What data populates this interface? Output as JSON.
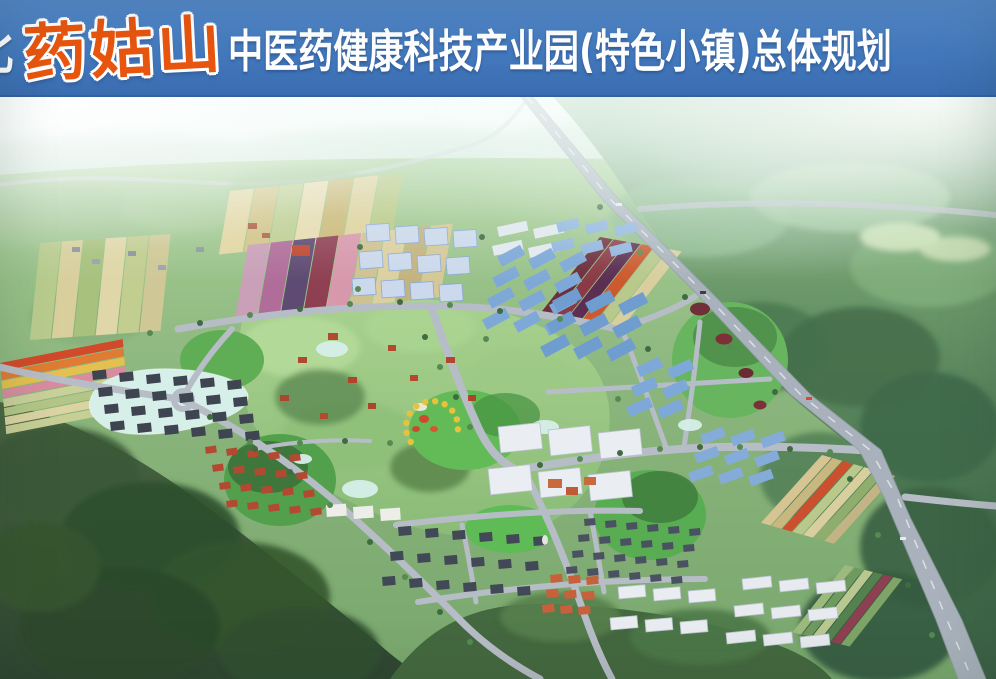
{
  "banner": {
    "region": "湖北",
    "brand": "药姑山",
    "suffix": "中医药健康科技产业园(特色小镇)总体规划",
    "bg_color": "#4379bd",
    "text_color": "#ffffff",
    "brand_color": "#e8550e"
  },
  "scene": {
    "palette": {
      "sky": "#f2faf7",
      "distant_hills": "#c9e0d2",
      "terrain": "#8ab57c",
      "forest_right": "#47724f",
      "forest_dark": "#2f4a31",
      "park": "#9dc688",
      "water": "#d6efe9",
      "road": "#b7bdc6",
      "highway": "#a9b2bc"
    },
    "farm_groups": [
      {
        "name": "farm-main-upper",
        "x": 230,
        "y": 94,
        "rot": -6,
        "skew": -16,
        "sw": 25,
        "len": 62,
        "colors": [
          "#e3d6a2",
          "#d3c488",
          "#bfcf92",
          "#e8dcb0",
          "#ccb977",
          "#dfd29c",
          "#b9c985"
        ]
      },
      {
        "name": "farm-main-lower",
        "x": 248,
        "y": 148,
        "rot": -6,
        "skew": -16,
        "sw": 23,
        "len": 72,
        "colors": [
          "#caa0b8",
          "#b06d9a",
          "#5e4a72",
          "#8f3f52",
          "#d898ac",
          "#cfc292",
          "#dcd0a0",
          "#c3b47e",
          "#d6c896"
        ]
      },
      {
        "name": "farm-left",
        "x": 40,
        "y": 146,
        "rot": -4,
        "skew": -10,
        "sw": 22,
        "len": 96,
        "colors": [
          "#b9cc8e",
          "#d8cf9c",
          "#a8c17d",
          "#e0d7a8",
          "#c2cd90",
          "#cfc896"
        ]
      },
      {
        "name": "farm-rainbow-strips",
        "x": 0,
        "y": 266,
        "rot": -11,
        "skew": -6,
        "sw": 9,
        "len": 125,
        "dir": "h",
        "colors": [
          "#d14a2a",
          "#e07b33",
          "#e3c04f",
          "#d98ca0",
          "#c9d09a",
          "#b3c687",
          "#dbd3a2",
          "#c7ce96"
        ]
      },
      {
        "name": "farm-east-maroon",
        "x": 600,
        "y": 140,
        "rot": 10,
        "skew": -28,
        "sw": 14,
        "len": 86,
        "colors": [
          "#6e2f3c",
          "#8a3a46",
          "#5c2f52",
          "#cc5a2e",
          "#b9c98c",
          "#d9cf9e"
        ]
      },
      {
        "name": "farm-highway-strips",
        "x": 822,
        "y": 358,
        "rot": 16,
        "skew": -26,
        "sw": 11,
        "len": 82,
        "colors": [
          "#d6c493",
          "#c8b87f",
          "#cc4f2e",
          "#b9c98c",
          "#d9cf9e",
          "#8fae6e",
          "#c2b484"
        ]
      },
      {
        "name": "farm-south-strips",
        "x": 845,
        "y": 468,
        "rot": 14,
        "skew": -24,
        "sw": 10,
        "len": 78,
        "colors": [
          "#9cb97e",
          "#6f9a5f",
          "#b8c890",
          "#55814f",
          "#8f3f52",
          "#7ea468"
        ]
      }
    ],
    "clusters": [
      {
        "name": "factory-white-blue-A",
        "x": 366,
        "y": 128,
        "cols": 4,
        "rows": 3,
        "dx": 29,
        "dy": 27,
        "shx": -7,
        "shy": 2,
        "w": 23,
        "h": 17,
        "rot": -4,
        "color": "#ccd9ec",
        "stroke": "#8aa9d6"
      },
      {
        "name": "white-sheds-row",
        "x": 497,
        "y": 130,
        "cols": 2,
        "rows": 2,
        "dx": 36,
        "dy": 19,
        "shx": -5,
        "shy": 2,
        "w": 30,
        "h": 10,
        "rot": -12,
        "color": "#e2e8ef"
      },
      {
        "name": "factory-blue-small-top",
        "x": 556,
        "y": 126,
        "cols": 3,
        "rows": 2,
        "dx": 29,
        "dy": 20,
        "shx": -5,
        "shy": 2,
        "w": 22,
        "h": 10,
        "rot": -14,
        "color": "#90b4de"
      },
      {
        "name": "factory-blue-sheds-B",
        "x": 497,
        "y": 160,
        "cols": 3,
        "rows": 4,
        "dx": 31,
        "dy": 21,
        "shx": -5,
        "shy": 3,
        "w": 26,
        "h": 11,
        "rot": -28,
        "color": "#7ea8d8"
      },
      {
        "name": "factory-blue-sheds-C",
        "x": 552,
        "y": 204,
        "cols": 3,
        "rows": 3,
        "dx": 33,
        "dy": 23,
        "shx": -6,
        "shy": 2,
        "w": 28,
        "h": 12,
        "rot": -28,
        "color": "#6f9dd0"
      },
      {
        "name": "factory-blue-sheds-D",
        "x": 636,
        "y": 270,
        "cols": 2,
        "rows": 3,
        "dx": 31,
        "dy": 20,
        "shx": -5,
        "shy": 2,
        "w": 25,
        "h": 11,
        "rot": -24,
        "color": "#7ea8d8"
      },
      {
        "name": "factory-blue-sheds-E",
        "x": 700,
        "y": 338,
        "cols": 3,
        "rows": 3,
        "dx": 30,
        "dy": 19,
        "shx": -6,
        "shy": 2,
        "w": 24,
        "h": 10,
        "rot": -20,
        "color": "#85acd9"
      },
      {
        "name": "factory-white-F",
        "x": 498,
        "y": 330,
        "cols": 3,
        "rows": 2,
        "dx": 50,
        "dy": 42,
        "shx": -10,
        "shy": 3,
        "w": 42,
        "h": 26,
        "rot": -6,
        "color": "#eaedf2",
        "stroke": "#b9c2cc"
      },
      {
        "name": "apartments-lakeside",
        "x": 92,
        "y": 274,
        "cols": 6,
        "rows": 4,
        "dx": 27,
        "dy": 17,
        "shx": 6,
        "shy": 2,
        "w": 14,
        "h": 9,
        "rot": -6,
        "color": "#3e4450"
      },
      {
        "name": "villas-red",
        "x": 205,
        "y": 350,
        "cols": 5,
        "rows": 4,
        "dx": 21,
        "dy": 18,
        "shx": 7,
        "shy": 2,
        "w": 11,
        "h": 7,
        "rot": -8,
        "color": "#b24a31"
      },
      {
        "name": "apartments-south",
        "x": 398,
        "y": 430,
        "cols": 6,
        "rows": 3,
        "dx": 27,
        "dy": 25,
        "shx": -8,
        "shy": 2,
        "w": 13,
        "h": 9,
        "rot": -5,
        "color": "#424956"
      },
      {
        "name": "residential-grid-east",
        "x": 584,
        "y": 422,
        "cols": 6,
        "rows": 4,
        "dx": 21,
        "dy": 16,
        "shx": -6,
        "shy": 2,
        "w": 11,
        "h": 7,
        "rot": -5,
        "color": "#4a5261"
      },
      {
        "name": "orange-complex",
        "x": 550,
        "y": 478,
        "cols": 3,
        "rows": 3,
        "dx": 18,
        "dy": 15,
        "shx": -4,
        "shy": 1,
        "w": 12,
        "h": 8,
        "rot": -6,
        "color": "#c8603c"
      },
      {
        "name": "white-offices-south",
        "x": 618,
        "y": 490,
        "cols": 3,
        "rows": 2,
        "dx": 35,
        "dy": 31,
        "shx": -8,
        "shy": 2,
        "w": 27,
        "h": 12,
        "rot": -5,
        "color": "#e9ecf1",
        "stroke": "#b9c2cc"
      },
      {
        "name": "white-offices-east",
        "x": 742,
        "y": 482,
        "cols": 3,
        "rows": 3,
        "dx": 37,
        "dy": 27,
        "shx": -8,
        "shy": 2,
        "w": 29,
        "h": 11,
        "rot": -6,
        "color": "#e7eaef",
        "stroke": "#b9c2cc"
      },
      {
        "name": "clinic-white",
        "x": 326,
        "y": 408,
        "cols": 3,
        "rows": 1,
        "dx": 27,
        "dy": 0,
        "shx": 0,
        "shy": 2,
        "w": 20,
        "h": 12,
        "rot": -4,
        "color": "#edede9"
      }
    ],
    "ponds": [
      [
        332,
        252,
        16,
        8
      ],
      [
        545,
        330,
        14,
        7
      ],
      [
        360,
        392,
        18,
        9
      ],
      [
        690,
        328,
        12,
        6
      ],
      [
        302,
        362,
        10,
        5
      ]
    ],
    "arc_feature": {
      "cx": 432,
      "cy": 330,
      "r": 26,
      "start": -215,
      "end": 5,
      "n": 11,
      "dot": 3.2,
      "color": "#e6c33c"
    },
    "scatter": [
      [
        328,
        236,
        10,
        7,
        "#b5492f"
      ],
      [
        298,
        260,
        9,
        6,
        "#b0472e"
      ],
      [
        348,
        280,
        9,
        6,
        "#ad452c"
      ],
      [
        388,
        248,
        8,
        6,
        "#b5492f"
      ],
      [
        280,
        298,
        9,
        6,
        "#a84830"
      ],
      [
        320,
        316,
        8,
        6,
        "#b5492f"
      ],
      [
        368,
        306,
        8,
        6,
        "#ad452c"
      ],
      [
        410,
        278,
        8,
        6,
        "#b5492f"
      ],
      [
        446,
        260,
        9,
        6,
        "#b0472e"
      ],
      [
        468,
        298,
        8,
        6,
        "#ad452c"
      ],
      [
        424,
        322,
        10,
        8,
        "#cc4a2e",
        "e"
      ],
      [
        434,
        332,
        8,
        6,
        "#d4582f",
        "e"
      ],
      [
        416,
        332,
        8,
        6,
        "#c94b2e",
        "e"
      ],
      [
        420,
        310,
        14,
        8,
        "#eae6dc",
        "e"
      ],
      [
        700,
        212,
        20,
        13,
        "#70303a",
        "e"
      ],
      [
        724,
        242,
        17,
        11,
        "#7e3038",
        "e"
      ],
      [
        746,
        276,
        15,
        10,
        "#6b2b34",
        "e"
      ],
      [
        760,
        308,
        13,
        9,
        "#7e3038",
        "e"
      ],
      [
        292,
        148,
        18,
        11,
        "#c0452f"
      ],
      [
        72,
        150,
        8,
        5,
        "#8a93a0"
      ],
      [
        92,
        162,
        8,
        5,
        "#99a2ae"
      ],
      [
        128,
        154,
        8,
        5,
        "#8a93a0"
      ],
      [
        158,
        168,
        8,
        5,
        "#9aa3af"
      ],
      [
        196,
        150,
        8,
        5,
        "#9099a5"
      ],
      [
        248,
        126,
        9,
        6,
        "#aa5a40"
      ],
      [
        262,
        136,
        8,
        5,
        "#b06048"
      ],
      [
        548,
        382,
        14,
        9,
        "#c86a3e"
      ],
      [
        566,
        390,
        12,
        8,
        "#bf5c36"
      ],
      [
        584,
        380,
        12,
        8,
        "#c86a3e"
      ],
      [
        545,
        443,
        6,
        10,
        "#e6e6e0",
        "e"
      ],
      [
        616,
        106,
        6,
        3,
        "#e8eaec"
      ],
      [
        700,
        194,
        6,
        3,
        "#3a4049"
      ],
      [
        806,
        300,
        6,
        3,
        "#d94b2e"
      ],
      [
        900,
        440,
        6,
        3,
        "#e8eaec"
      ]
    ],
    "trees": [
      [
        150,
        236
      ],
      [
        200,
        226
      ],
      [
        250,
        218
      ],
      [
        300,
        212
      ],
      [
        350,
        207
      ],
      [
        400,
        205
      ],
      [
        450,
        208
      ],
      [
        500,
        214
      ],
      [
        560,
        222
      ],
      [
        425,
        240
      ],
      [
        440,
        270
      ],
      [
        456,
        300
      ],
      [
        470,
        330
      ],
      [
        540,
        368
      ],
      [
        580,
        362
      ],
      [
        620,
        356
      ],
      [
        660,
        352
      ],
      [
        700,
        350
      ],
      [
        740,
        350
      ],
      [
        790,
        352
      ],
      [
        830,
        355
      ],
      [
        210,
        320
      ],
      [
        250,
        345
      ],
      [
        290,
        375
      ],
      [
        330,
        408
      ],
      [
        370,
        445
      ],
      [
        405,
        480
      ],
      [
        440,
        515
      ],
      [
        470,
        545
      ],
      [
        360,
        150
      ],
      [
        358,
        192
      ],
      [
        482,
        140
      ],
      [
        486,
        242
      ],
      [
        648,
        252
      ],
      [
        618,
        302
      ],
      [
        600,
        110
      ],
      [
        640,
        155
      ],
      [
        685,
        200
      ],
      [
        730,
        250
      ],
      [
        775,
        295
      ],
      [
        818,
        342
      ],
      [
        850,
        382
      ],
      [
        878,
        438
      ],
      [
        908,
        488
      ],
      [
        932,
        538
      ],
      [
        255,
        352
      ],
      [
        300,
        346
      ],
      [
        345,
        344
      ],
      [
        390,
        346
      ]
    ]
  }
}
